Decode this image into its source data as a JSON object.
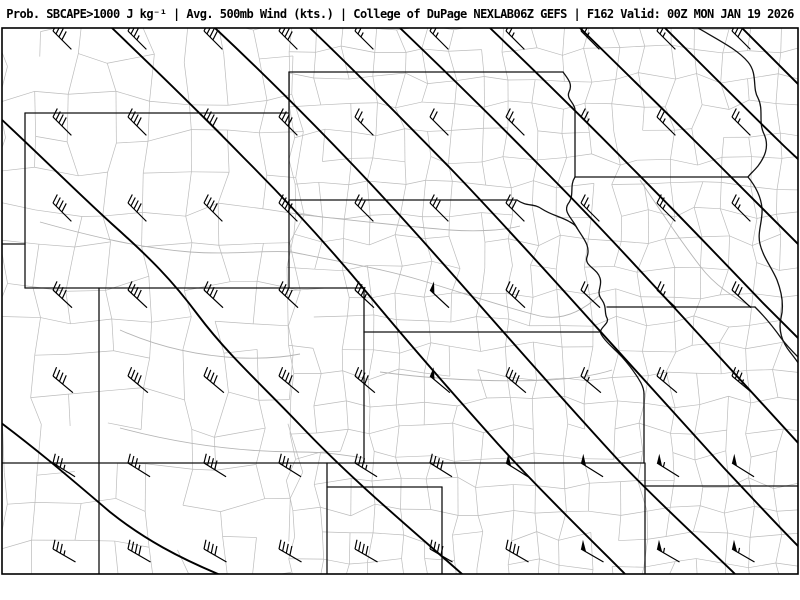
{
  "title_bar": {
    "text": "Prob. SBCAPE>1000 J kg⁻¹ | Avg. 500mb Wind (kts.) | College of DuPage NEXLAB06Z GEFS | F162 Valid: 00Z MON JAN 19 2026"
  },
  "map": {
    "product": "Probability of SBCAPE greater than 1000 J/kg with average 500mb wind barbs",
    "region": "Central Plains (WY, SD, NE, CO, KS, IA, MO sector)",
    "frame": {
      "x": 2,
      "y": 28,
      "width": 796,
      "height": 546
    },
    "colors": {
      "background": "#ffffff",
      "county_lines": "#bcbcbc",
      "rivers": "#b5b5b5",
      "state_borders": "#111111",
      "contours": "#000000",
      "wind_barbs": "#000000",
      "frame": "#000000",
      "title_text": "#000000"
    },
    "state_borders": [
      "M 25 113 L 289 113",
      "M 25 113 L 25 244",
      "M 0 244 L 25 244",
      "M 25 244 L 25 288",
      "M 25 288 L 364 288",
      "M 99 288 L 99 574",
      "M 0 463 L 644 463",
      "M 289 72 L 289 288",
      "M 289 72 L 563 72",
      "M 364 288 L 364 463",
      "M 364 332 L 600 332",
      "M 289 200 L 517 200",
      "M 517 200 C 527 207 534 203 542 209 C 551 215 562 217 570 222 C 574 224 576 226 577 228",
      "M 577 228 C 583 238 591 246 587 257 C 584 266 597 268 600 278 C 603 287 595 291 602 300 C 607 307 604 313 607 318 C 610 324 598 328 601 334 C 605 342 616 350 622 357 C 630 366 636 374 641 383 C 643 387 644 390 644 394",
      "M 644 394 L 644 463",
      "M 645 463 L 645 574",
      "M 645 486 L 800 486",
      "M 327 463 L 327 574",
      "M 327 487 L 442 487",
      "M 442 487 L 442 574",
      "M 563 72 C 568 79 573 84 569 92 C 566 99 575 103 575 110 L 575 177",
      "M 575 177 L 748 177",
      "M 575 177 C 569 186 575 195 568 204 C 563 212 572 218 577 228",
      "M 698 28 C 722 42 738 50 748 62 C 758 74 752 88 758 98 C 764 110 758 122 764 134 C 770 147 764 158 758 166 C 753 172 750 174 748 177",
      "M 748 177 C 757 188 761 198 762 208 C 763 221 757 232 760 244 C 763 257 772 268 777 280 C 782 293 784 306 781 318 C 778 330 782 342 790 352 C 794 357 798 362 800 366",
      "M 755 307 C 766 318 774 328 781 338 C 787 346 793 352 798 357",
      "M 607 307 L 755 307"
    ],
    "rivers": [
      "M 292 252 C 340 262 380 268 420 280 C 460 292 500 306 540 316 C 566 322 588 306 600 295",
      "M 40 222 C 90 236 140 248 190 252 C 230 255 265 250 292 252",
      "M 296 214 C 350 220 400 226 450 230 C 480 232 505 230 520 226",
      "M 380 372 C 440 380 500 382 550 380 C 580 378 600 374 612 370",
      "M 120 428 C 180 444 240 452 300 452 C 330 452 350 456 363 458",
      "M 640 180 C 660 210 680 240 700 266 C 715 286 735 298 752 307",
      "M 120 330 C 160 348 200 356 240 358 C 270 359 290 356 300 354"
    ],
    "contours": [
      "M 0 422 C 40 452 70 478 110 512 C 145 540 180 558 218 574",
      "M 0 118 C 45 160 80 195 112 224 C 150 258 172 280 198 315 C 228 355 262 385 300 425 C 352 480 410 528 462 574",
      "M 112 28 C 160 74 205 118 244 158 C 288 202 330 248 368 294 C 410 345 455 396 498 444 C 540 490 585 534 625 574",
      "M 215 28 C 262 72 308 118 352 164 C 396 210 440 260 484 310 C 528 360 574 412 620 462 C 658 502 700 540 735 574",
      "M 310 28 C 358 74 405 122 452 170 C 498 218 545 270 590 320 C 635 370 680 420 724 468 C 756 502 780 528 800 548",
      "M 400 28 C 448 74 495 120 542 168 C 590 216 636 266 682 316 C 726 364 766 408 800 445",
      "M 490 28 C 538 74 585 120 630 166 C 676 212 720 258 762 302 C 776 316 790 330 800 340",
      "M 580 28 C 625 72 670 116 712 158 C 742 188 772 218 800 246",
      "M 665 28 C 705 68 745 108 782 144 C 788 150 795 156 800 161",
      "M 742 28 C 762 48 782 68 800 86"
    ],
    "wind_barbs": {
      "units": "kts",
      "format": [
        "x",
        "y",
        "wind_from_deg",
        "speed_kts"
      ],
      "points": [
        [
          53,
          31,
          315,
          40
        ],
        [
          128,
          31,
          315,
          35
        ],
        [
          204,
          31,
          315,
          40
        ],
        [
          279,
          31,
          315,
          40
        ],
        [
          355,
          31,
          315,
          25
        ],
        [
          430,
          31,
          315,
          25
        ],
        [
          506,
          31,
          315,
          25
        ],
        [
          581,
          31,
          315,
          25
        ],
        [
          657,
          31,
          315,
          25
        ],
        [
          732,
          31,
          315,
          30
        ],
        [
          53,
          117,
          315,
          40
        ],
        [
          128,
          117,
          315,
          40
        ],
        [
          204,
          117,
          315,
          40
        ],
        [
          279,
          117,
          315,
          40
        ],
        [
          355,
          117,
          315,
          25
        ],
        [
          430,
          117,
          315,
          20
        ],
        [
          506,
          117,
          315,
          25
        ],
        [
          581,
          117,
          315,
          25
        ],
        [
          657,
          117,
          315,
          25
        ],
        [
          732,
          117,
          315,
          25
        ],
        [
          53,
          203,
          315,
          40
        ],
        [
          128,
          203,
          315,
          40
        ],
        [
          204,
          203,
          315,
          40
        ],
        [
          279,
          203,
          315,
          40
        ],
        [
          355,
          203,
          315,
          30
        ],
        [
          430,
          203,
          315,
          30
        ],
        [
          506,
          203,
          315,
          30
        ],
        [
          581,
          203,
          315,
          25
        ],
        [
          657,
          203,
          315,
          25
        ],
        [
          732,
          203,
          315,
          25
        ],
        [
          53,
          290,
          313,
          40
        ],
        [
          128,
          290,
          313,
          40
        ],
        [
          204,
          290,
          313,
          40
        ],
        [
          279,
          290,
          313,
          40
        ],
        [
          355,
          290,
          313,
          35
        ],
        [
          430,
          290,
          313,
          50
        ],
        [
          506,
          290,
          313,
          40
        ],
        [
          581,
          290,
          313,
          20
        ],
        [
          657,
          290,
          313,
          25
        ],
        [
          732,
          290,
          313,
          30
        ],
        [
          53,
          376,
          310,
          40
        ],
        [
          128,
          376,
          310,
          40
        ],
        [
          204,
          376,
          310,
          40
        ],
        [
          279,
          376,
          310,
          40
        ],
        [
          355,
          376,
          310,
          40
        ],
        [
          430,
          376,
          310,
          50
        ],
        [
          506,
          376,
          310,
          40
        ],
        [
          581,
          376,
          310,
          25
        ],
        [
          657,
          376,
          310,
          30
        ],
        [
          732,
          376,
          310,
          35
        ],
        [
          53,
          463,
          302,
          35
        ],
        [
          128,
          463,
          302,
          35
        ],
        [
          204,
          463,
          302,
          40
        ],
        [
          279,
          463,
          302,
          35
        ],
        [
          355,
          463,
          302,
          35
        ],
        [
          430,
          463,
          302,
          40
        ],
        [
          506,
          463,
          302,
          50
        ],
        [
          581,
          463,
          302,
          50
        ],
        [
          657,
          463,
          302,
          55
        ],
        [
          732,
          463,
          302,
          50
        ],
        [
          53,
          549,
          300,
          35
        ],
        [
          128,
          549,
          300,
          40
        ],
        [
          204,
          549,
          300,
          40
        ],
        [
          279,
          549,
          300,
          40
        ],
        [
          355,
          549,
          300,
          40
        ],
        [
          430,
          549,
          300,
          40
        ],
        [
          506,
          549,
          300,
          40
        ],
        [
          581,
          549,
          300,
          50
        ],
        [
          657,
          549,
          300,
          55
        ],
        [
          732,
          549,
          300,
          55
        ]
      ]
    }
  }
}
